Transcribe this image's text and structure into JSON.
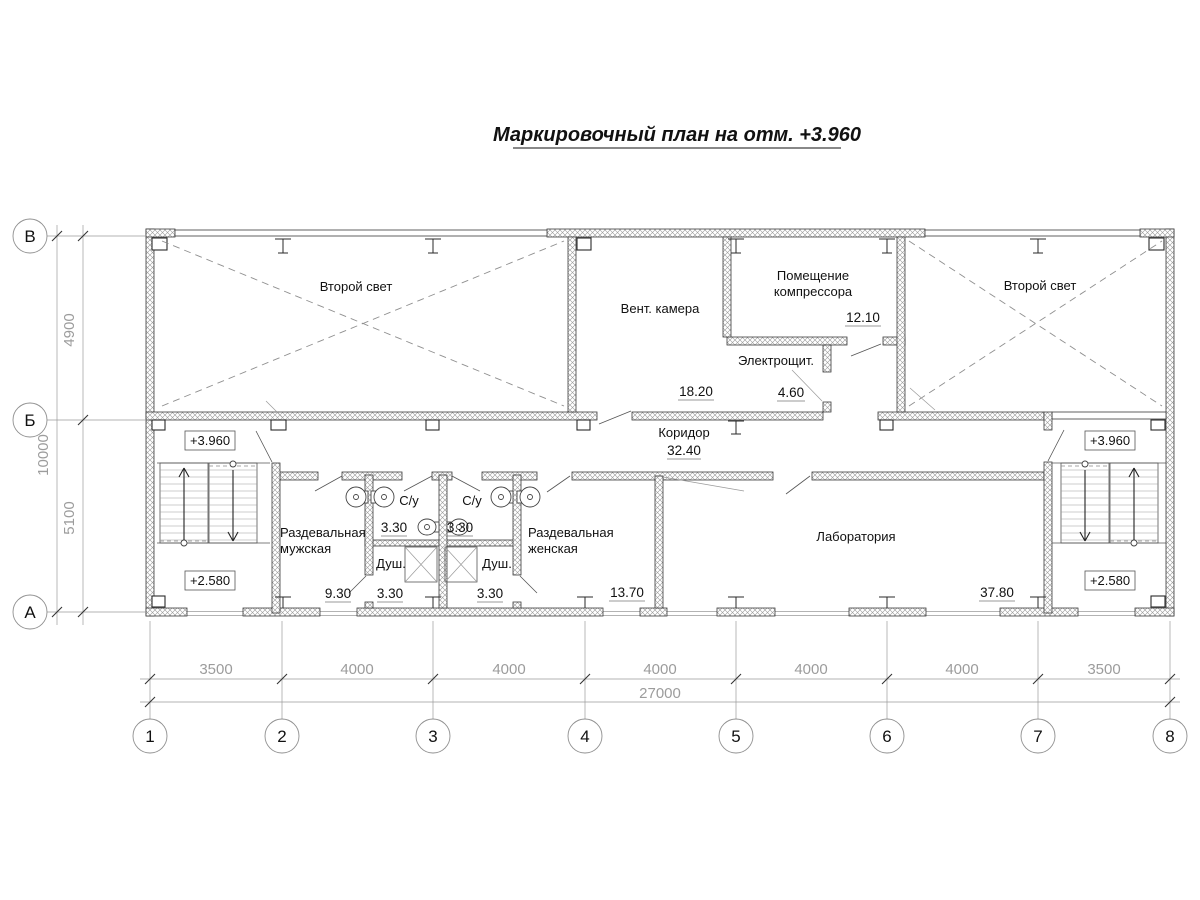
{
  "palette": {
    "line": "#3a3a3a",
    "dim_text": "#9c9c9c",
    "text": "#111111",
    "wall_hatch": "#9a9a9a",
    "background": "#ffffff"
  },
  "title": {
    "text": "Маркировочный план на отм. +3.960"
  },
  "axis_rows": [
    {
      "label": "В"
    },
    {
      "label": "Б"
    },
    {
      "label": "А"
    }
  ],
  "axis_cols": [
    {
      "label": "1"
    },
    {
      "label": "2"
    },
    {
      "label": "3"
    },
    {
      "label": "4"
    },
    {
      "label": "5"
    },
    {
      "label": "6"
    },
    {
      "label": "7"
    },
    {
      "label": "8"
    }
  ],
  "dims": {
    "spans": [
      "3500",
      "4000",
      "4000",
      "4000",
      "4000",
      "4000",
      "3500"
    ],
    "total": "27000",
    "left_overall": "10000",
    "left_upper": "4900",
    "left_lower": "5100"
  },
  "levels": {
    "upper": "+3.960",
    "lower": "+2.580"
  },
  "rooms": {
    "second_light_left": {
      "name": "Второй свет"
    },
    "second_light_right": {
      "name": "Второй свет"
    },
    "vent": {
      "name": "Вент. камера",
      "area": "18.20"
    },
    "compressor": {
      "name_line1": "Помещение",
      "name_line2": "компрессора",
      "area": "12.10"
    },
    "electro": {
      "name": "Электрощит.",
      "area": "4.60"
    },
    "corridor": {
      "name": "Коридор",
      "area": "32.40"
    },
    "lab": {
      "name": "Лаборатория",
      "area": "37.80"
    },
    "dress_m": {
      "name_line1": "Раздевальная",
      "name_line2": "мужская",
      "area": "9.30"
    },
    "dress_f": {
      "name_line1": "Раздевальная",
      "name_line2": "женская",
      "area": "13.70"
    },
    "su_left": {
      "name": "С/у",
      "area": "3.30"
    },
    "su_right": {
      "name": "С/у",
      "area": "3.30"
    },
    "shower_left": {
      "name": "Душ.",
      "area": "3.30"
    },
    "shower_right": {
      "name": "Душ.",
      "area": "3.30"
    }
  }
}
